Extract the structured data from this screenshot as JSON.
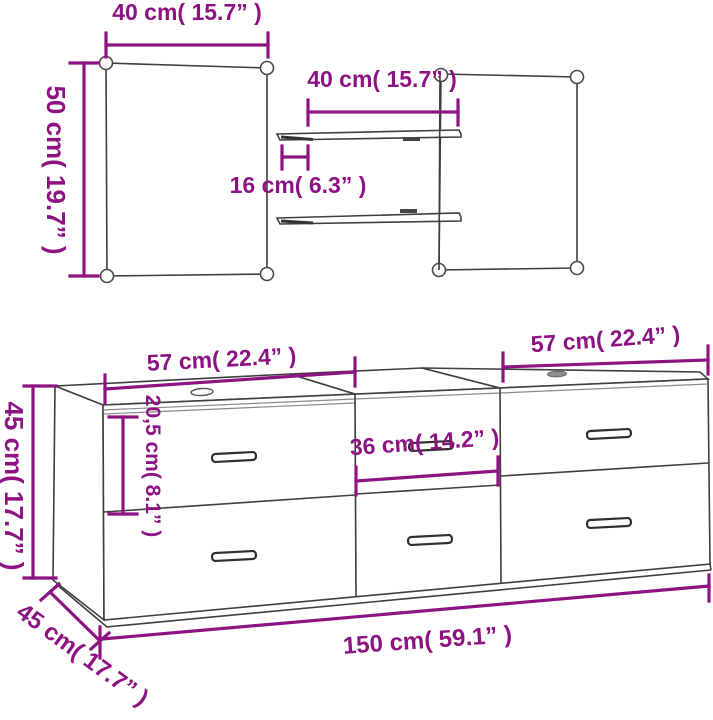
{
  "diagram": {
    "kind": "product-dimension-diagram",
    "product": "bathroom furniture set: two mirrors, two wall shelves, three-module drawer cabinet"
  },
  "colors": {
    "dimension_magenta": "#8e1382",
    "line_dark": "#3f3f3f",
    "line_light": "#8a8a8a",
    "background": "#ffffff"
  },
  "labels": {
    "mirror_width": "40 cm( 15.7” )",
    "mirror_height": "50 cm( 19.7” )",
    "shelf_width": "40 cm( 15.7” )",
    "shelf_depth": "16 cm( 6.3” )",
    "cabinet_left_width": "57 cm( 22.4” )",
    "cabinet_right_width": "57 cm( 22.4” )",
    "cabinet_height": "45 cm( 17.7” )",
    "drawer_height": "20,5 cm( 8.1” )",
    "cabinet_middle_width": "36 cm( 14.2” )",
    "cabinet_depth": "45 cm( 17.7” )",
    "cabinet_total_width": "150 cm( 59.1” )"
  }
}
